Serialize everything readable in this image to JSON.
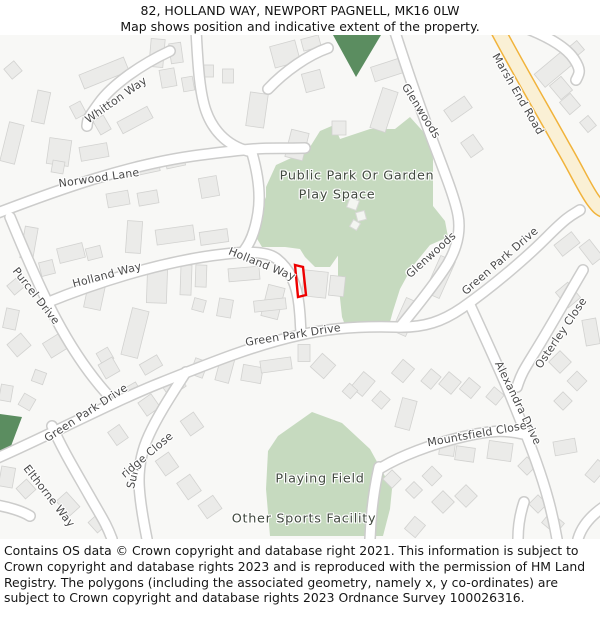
{
  "header": {
    "title": "82, HOLLAND WAY, NEWPORT PAGNELL, MK16 0LW",
    "subtitle": "Map shows position and indicative extent of the property."
  },
  "map": {
    "labels": {
      "whitton_way": "Whitton Way",
      "norwood_lane": "Norwood Lane",
      "holland_way_west": "Holland Way",
      "holland_way_east": "Holland Way",
      "purcel_drive": "Purcel Drive",
      "green_park_drive_sw": "Green Park Drive",
      "green_park_drive_mid": "Green Park Drive",
      "green_park_drive_ne": "Green Park Drive",
      "glenwoods_north": "Glenwoods",
      "glenwoods_south": "Glenwoods",
      "marsh_end_road": "Marsh End Road",
      "osterley_close": "Osterley Close",
      "alexandra_drive": "Alexandra Drive",
      "mountsfield_close": "Mountsfield Close",
      "elthorne_way": "Elthorne Way",
      "sunridge_close": {
        "full": "Sunridge Close",
        "part1": "Sun",
        "part2": "ridge Close"
      },
      "public_park": "Public Park Or Garden",
      "play_space": "Play Space",
      "playing_field": "Playing Field",
      "other_sports_facility": "Other Sports Facility"
    },
    "colors": {
      "greenspace": "#c6dabf",
      "dark_green": "#5b8d60",
      "building": "#ebebe9",
      "building_border": "#d2d2d0",
      "road_fill": "#ffffff",
      "road_casing": "#cccccb",
      "primary_road_fill": "#faf0d5",
      "primary_road_border": "#f1b33b",
      "property_outline": "#ee0000"
    }
  },
  "footer": {
    "copyright": "Contains OS data © Crown copyright and database right 2021. This information is subject to Crown copyright and database rights 2023 and is reproduced with the permission of HM Land Registry. The polygons (including the associated geometry, namely x, y co-ordinates) are subject to Crown copyright and database rights 2023 Ordnance Survey 100026316."
  }
}
